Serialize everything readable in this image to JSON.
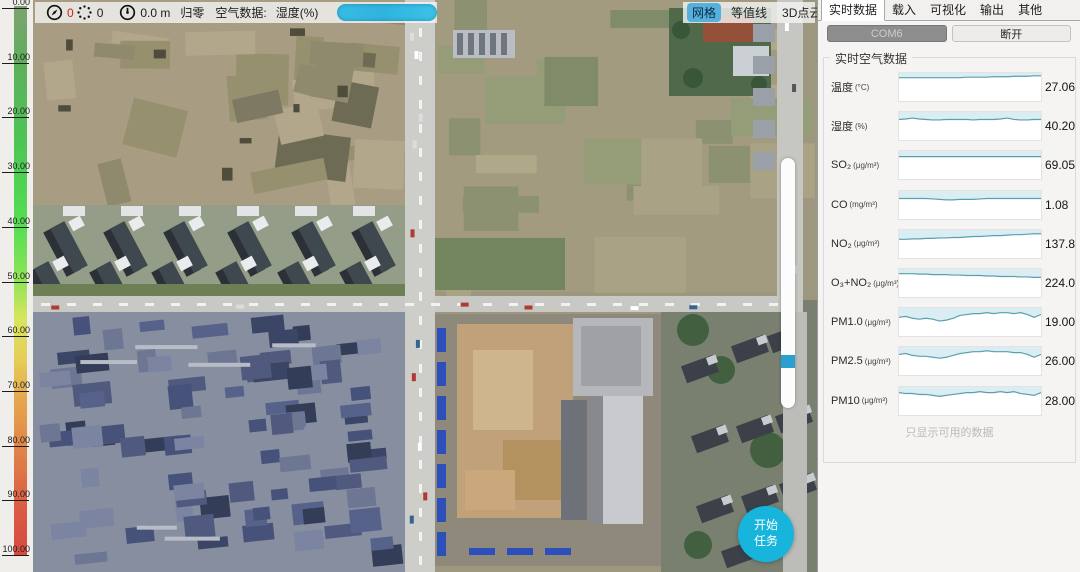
{
  "colorbar": {
    "ticks": [
      "0.00",
      "10.00",
      "20.00",
      "30.00",
      "40.00",
      "50.00",
      "60.00",
      "70.00",
      "80.00",
      "90.00",
      "100.00"
    ],
    "gradient": [
      [
        "0%",
        "#7ea272"
      ],
      [
        "10%",
        "#60ae5c"
      ],
      [
        "25%",
        "#4cc654"
      ],
      [
        "40%",
        "#55de53"
      ],
      [
        "50%",
        "#90e457"
      ],
      [
        "57%",
        "#d8e55e"
      ],
      [
        "64%",
        "#e5cf58"
      ],
      [
        "72%",
        "#e5a54e"
      ],
      [
        "82%",
        "#df7f49"
      ],
      [
        "92%",
        "#da5a44"
      ],
      [
        "100%",
        "#d74a41"
      ]
    ]
  },
  "toolbar": {
    "compass_value": "0",
    "satellite_count": "0",
    "altitude": "0.0 m",
    "zero_button": "归零",
    "air_data_label": "空气数据:",
    "air_data_metric": "湿度(%)"
  },
  "icons": {
    "heading": "compass-icon",
    "satellites": "satellite-dots-icon",
    "altitude": "gauge-icon"
  },
  "map_controls": {
    "grid": "网格",
    "contour": "等值线",
    "pointcloud": "3D点云"
  },
  "start_task_button": {
    "line1": "开始",
    "line2": "任务"
  },
  "panel": {
    "tabs": [
      "实时数据",
      "载入",
      "可视化",
      "输出",
      "其他"
    ],
    "active_tab": "实时数据",
    "tab_ids": [
      "tab-realtime",
      "tab-load",
      "tab-visualize",
      "tab-output",
      "tab-other"
    ],
    "port_button": "COM6",
    "disconnect_button": "断开",
    "group_title": "实时空气数据",
    "footer_note": "只显示可用的数据"
  },
  "chart_data": {
    "type": "line",
    "title": "实时空气数据",
    "line_color": "#5b9fae",
    "fill_color": "#d9edf3",
    "y_box_height": 30,
    "series": [
      {
        "name": "温度",
        "unit": "(°C)",
        "value": "27.06",
        "points": [
          5,
          5,
          5,
          5,
          5,
          5,
          5,
          5,
          5,
          5,
          4.5,
          4.5,
          4.5,
          4.5,
          4,
          4,
          4,
          3.5,
          3.5,
          3.5,
          3,
          3
        ]
      },
      {
        "name": "湿度",
        "unit": "(%)",
        "value": "40.20",
        "points": [
          8,
          7.5,
          6.5,
          7.5,
          8,
          8.5,
          8.5,
          8,
          8,
          8,
          8,
          8.5,
          8,
          8,
          8,
          7.5,
          6.5,
          8,
          8.5,
          8.5,
          8,
          8
        ]
      },
      {
        "name": "SO₂",
        "unit": "(μg/m³)",
        "value": "69.05",
        "points": [
          6,
          6,
          6,
          6,
          6,
          6,
          6,
          6,
          6,
          6,
          6,
          6,
          6,
          6,
          6,
          6,
          6,
          6,
          6,
          6,
          6,
          6
        ]
      },
      {
        "name": "CO",
        "unit": "(mg/m³)",
        "value": "1.08",
        "points": [
          8,
          8,
          8,
          8,
          8,
          8.5,
          9,
          9.5,
          9.5,
          9,
          9,
          9,
          8.5,
          8,
          8,
          8,
          8,
          8,
          8,
          8,
          8,
          8
        ]
      },
      {
        "name": "NO₂",
        "unit": "(μg/m³)",
        "value": "137.8",
        "points": [
          10,
          10,
          9.5,
          9.5,
          9,
          9,
          8.5,
          8.5,
          8,
          8,
          7.5,
          7,
          7,
          6.5,
          6,
          6,
          5.5,
          5,
          5,
          4.5,
          4,
          4
        ]
      },
      {
        "name": "O₃+NO₂",
        "unit": "(μg/m³)",
        "value": "224.0",
        "points": [
          5,
          5,
          5,
          5.5,
          5.5,
          6,
          6,
          6,
          6.5,
          6.5,
          7,
          7,
          7,
          7.5,
          7.5,
          8,
          8,
          8,
          8.5,
          8.5,
          9,
          9
        ]
      },
      {
        "name": "PM1.0",
        "unit": "(μg/m³)",
        "value": "19.00",
        "points": [
          10,
          9,
          11,
          12,
          11,
          12,
          14,
          13,
          11,
          8,
          7,
          6,
          6,
          5,
          6,
          5,
          5,
          6,
          5,
          7,
          10,
          7
        ]
      },
      {
        "name": "PM2.5",
        "unit": "(μg/m³)",
        "value": "26.00",
        "points": [
          8,
          7,
          9,
          10,
          10,
          11,
          12,
          11,
          9,
          7,
          6,
          5,
          5,
          4,
          5,
          5,
          5,
          6,
          6,
          8,
          11,
          8
        ]
      },
      {
        "name": "PM10",
        "unit": "(μg/m³)",
        "value": "28.00",
        "points": [
          6,
          7,
          7,
          8,
          8,
          9,
          10,
          9,
          8,
          7,
          6,
          6,
          5,
          6,
          6,
          5,
          6,
          5,
          7,
          8,
          9,
          6
        ]
      }
    ]
  }
}
